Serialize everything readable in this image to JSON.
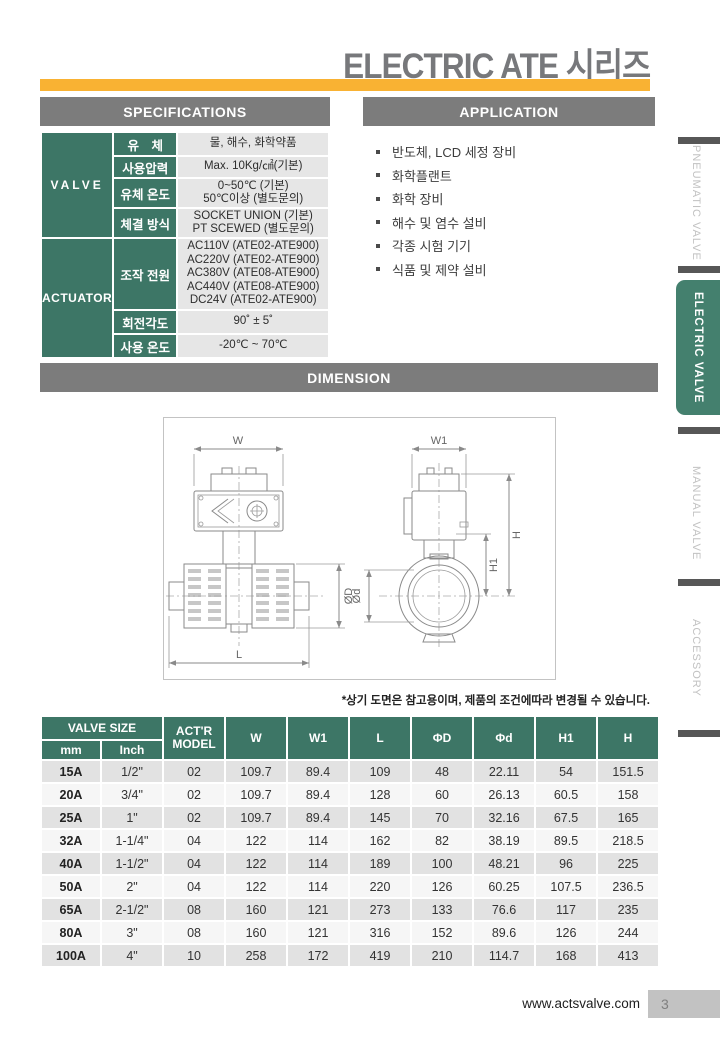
{
  "page": {
    "title": "ELECTRIC ATE 시리즈",
    "note": "*상기 도면은 참고용이며, 제품의 조건에따라 변경될 수 있습니다.",
    "footer_url": "www.actsvalve.com",
    "page_number": "3"
  },
  "colors": {
    "accent_green": "#3D7666",
    "active_tab_green": "#44806E",
    "accent_yellow": "#F9B233",
    "header_gray": "#7C7C7C"
  },
  "spec": {
    "header": "SPECIFICATIONS",
    "valve": {
      "name": "VALVE",
      "rows": [
        {
          "label": "유 체",
          "value": "물, 해수, 화학약품"
        },
        {
          "label": "사용압력",
          "value": "Max. 10Kg/㎠(기본)"
        },
        {
          "label": "유체 온도",
          "value": "0~50℃ (기본)\n50℃이상 (별도문의)"
        },
        {
          "label": "체결 방식",
          "value": "SOCKET UNION (기본)\nPT SCEWED (별도문의)"
        }
      ]
    },
    "actuator": {
      "name": "ACTUATOR",
      "rows": [
        {
          "label": "조작 전원",
          "value": "AC110V (ATE02-ATE900)\nAC220V (ATE02-ATE900)\nAC380V (ATE08-ATE900)\nAC440V (ATE08-ATE900)\nDC24V (ATE02-ATE900)"
        },
        {
          "label": "회전각도",
          "value": "90˚ ± 5˚"
        },
        {
          "label": "사용 온도",
          "value": "-20℃ ~ 70℃"
        }
      ]
    }
  },
  "application": {
    "header": "APPLICATION",
    "items": [
      "반도체, LCD 세정 장비",
      "화학플랜트",
      "화학 장비",
      "해수 및 염수 설비",
      "각종 시험 기기",
      "식품 및 제약 설비"
    ]
  },
  "dimension": {
    "header": "DIMENSION",
    "drawing_labels": {
      "w": "W",
      "w1": "W1",
      "l": "L",
      "phiD": "ØD",
      "phid": "Ød",
      "h1": "H1",
      "h": "H"
    }
  },
  "dimension_table": {
    "headers": {
      "valve_size": "VALVE SIZE",
      "mm": "mm",
      "inch": "Inch",
      "actr_model": "ACT'R MODEL",
      "cols": [
        "W",
        "W1",
        "L",
        "ΦD",
        "Φd",
        "H1",
        "H"
      ]
    },
    "rows": [
      [
        "15A",
        "1/2\"",
        "02",
        "109.7",
        "89.4",
        "109",
        "48",
        "22.11",
        "54",
        "151.5"
      ],
      [
        "20A",
        "3/4\"",
        "02",
        "109.7",
        "89.4",
        "128",
        "60",
        "26.13",
        "60.5",
        "158"
      ],
      [
        "25A",
        "1\"",
        "02",
        "109.7",
        "89.4",
        "145",
        "70",
        "32.16",
        "67.5",
        "165"
      ],
      [
        "32A",
        "1-1/4\"",
        "04",
        "122",
        "114",
        "162",
        "82",
        "38.19",
        "89.5",
        "218.5"
      ],
      [
        "40A",
        "1-1/2\"",
        "04",
        "122",
        "114",
        "189",
        "100",
        "48.21",
        "96",
        "225"
      ],
      [
        "50A",
        "2\"",
        "04",
        "122",
        "114",
        "220",
        "126",
        "60.25",
        "107.5",
        "236.5"
      ],
      [
        "65A",
        "2-1/2\"",
        "08",
        "160",
        "121",
        "273",
        "133",
        "76.6",
        "117",
        "235"
      ],
      [
        "80A",
        "3\"",
        "08",
        "160",
        "121",
        "316",
        "152",
        "89.6",
        "126",
        "244"
      ],
      [
        "100A",
        "4\"",
        "10",
        "258",
        "172",
        "419",
        "210",
        "114.7",
        "168",
        "413"
      ]
    ]
  },
  "sidebar": {
    "items": [
      {
        "label": "PNEUMATIC VALVE",
        "active": false
      },
      {
        "label": "ELECTRIC VALVE",
        "active": true
      },
      {
        "label": "MANUAL VALVE",
        "active": false
      },
      {
        "label": "ACCESSORY",
        "active": false
      }
    ]
  }
}
